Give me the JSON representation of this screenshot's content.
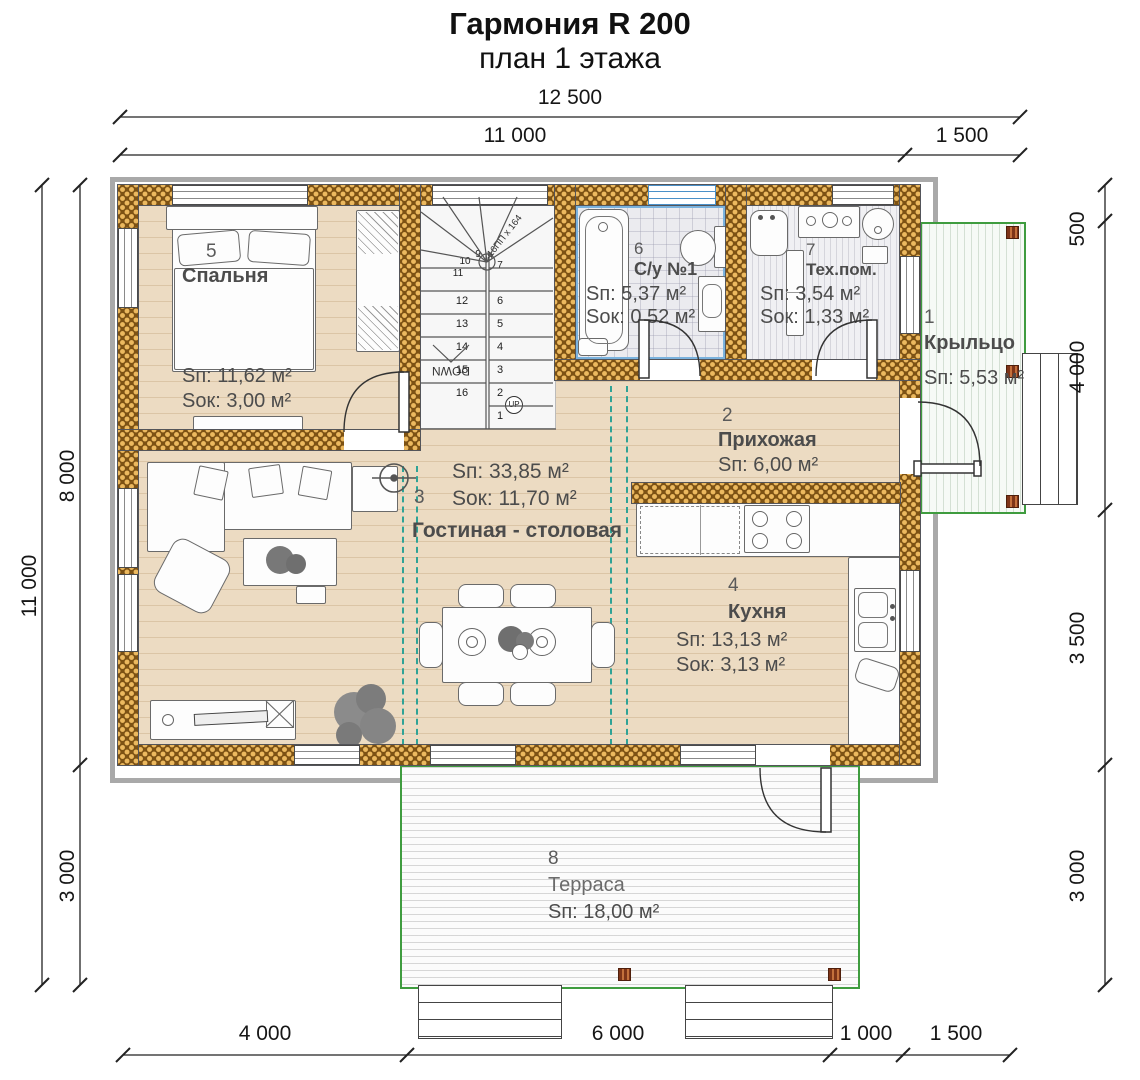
{
  "title": "Гармония R 200",
  "subtitle": "план 1 этажа",
  "dimensions": {
    "top_total": "12 500",
    "top_left": "11 000",
    "top_right": "1 500",
    "left_total": "11 000",
    "left_upper": "8 000",
    "left_lower": "3 000",
    "right": [
      "500",
      "4 000",
      "3 500",
      "3 000"
    ],
    "bottom": [
      "4 000",
      "6 000",
      "1 000",
      "1 500"
    ]
  },
  "rooms": {
    "porch": {
      "number": "1",
      "name": "Крыльцо",
      "area": "Sп: 5,53 м²"
    },
    "hall": {
      "number": "2",
      "name": "Прихожая",
      "area": "Sп: 6,00 м²"
    },
    "living": {
      "number": "3",
      "name": "Гостиная - столовая",
      "area": "Sп: 33,85 м²",
      "area_windows": "Sок: 11,70 м²"
    },
    "kitchen": {
      "number": "4",
      "name": "Кухня",
      "area": "Sп: 13,13 м²",
      "area_windows": "Sок: 3,13 м²"
    },
    "bedroom": {
      "number": "5",
      "name": "Спальня",
      "area": "Sп: 11,62 м²",
      "area_windows": "Sок: 3,00 м²"
    },
    "bathroom": {
      "number": "6",
      "name": "С/у №1",
      "area": "Sп: 5,37 м²",
      "area_windows": "Sок: 0,52 м²"
    },
    "tech": {
      "number": "7",
      "name": "Тех.пом.",
      "area": "Sп: 3,54 м²",
      "area_windows": "Sок: 1,33 м²"
    },
    "terrace": {
      "number": "8",
      "name": "Терраса",
      "area": "Sп: 18,00 м²"
    }
  },
  "stairs": {
    "up": "UP",
    "down": "DOWN",
    "note": "16ПП x 164",
    "right_numbers": [
      "1",
      "2",
      "3",
      "4",
      "5",
      "6"
    ],
    "winder_numbers": [
      "7",
      "8",
      "9",
      "10",
      "11"
    ],
    "left_numbers": [
      "12",
      "13",
      "14",
      "15",
      "16"
    ]
  },
  "colors": {
    "wall_brick": "#7d5214",
    "wall_dot": "#ecb95f",
    "zone_teal": "#2fa396",
    "deck_green": "#3f9c3f",
    "bath_blue": "#4a90c8"
  }
}
